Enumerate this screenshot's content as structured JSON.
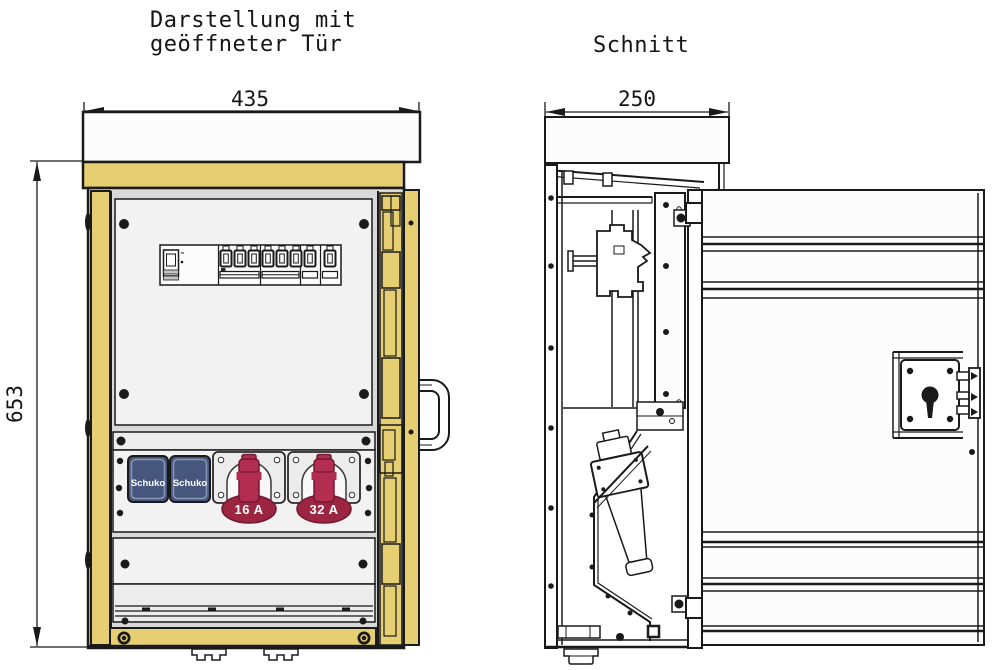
{
  "front_view": {
    "title_line1": "Darstellung mit",
    "title_line2": "geöffneter Tür",
    "dim_width": "435",
    "dim_height": "653",
    "sockets": {
      "schuko_left_label": "Schuko",
      "schuko_right_label": "Schuko",
      "cee_16_label": "16 A",
      "cee_32_label": "32 A"
    }
  },
  "section_view": {
    "title": "Schnitt",
    "dim_depth": "250"
  },
  "colors": {
    "cabinet_yellow": "#e5cf72",
    "schuko_blue": "#46567c",
    "cee_red": "#b22d50",
    "cee_red_dark": "#9c2542",
    "ink": "#1a1a1a"
  }
}
